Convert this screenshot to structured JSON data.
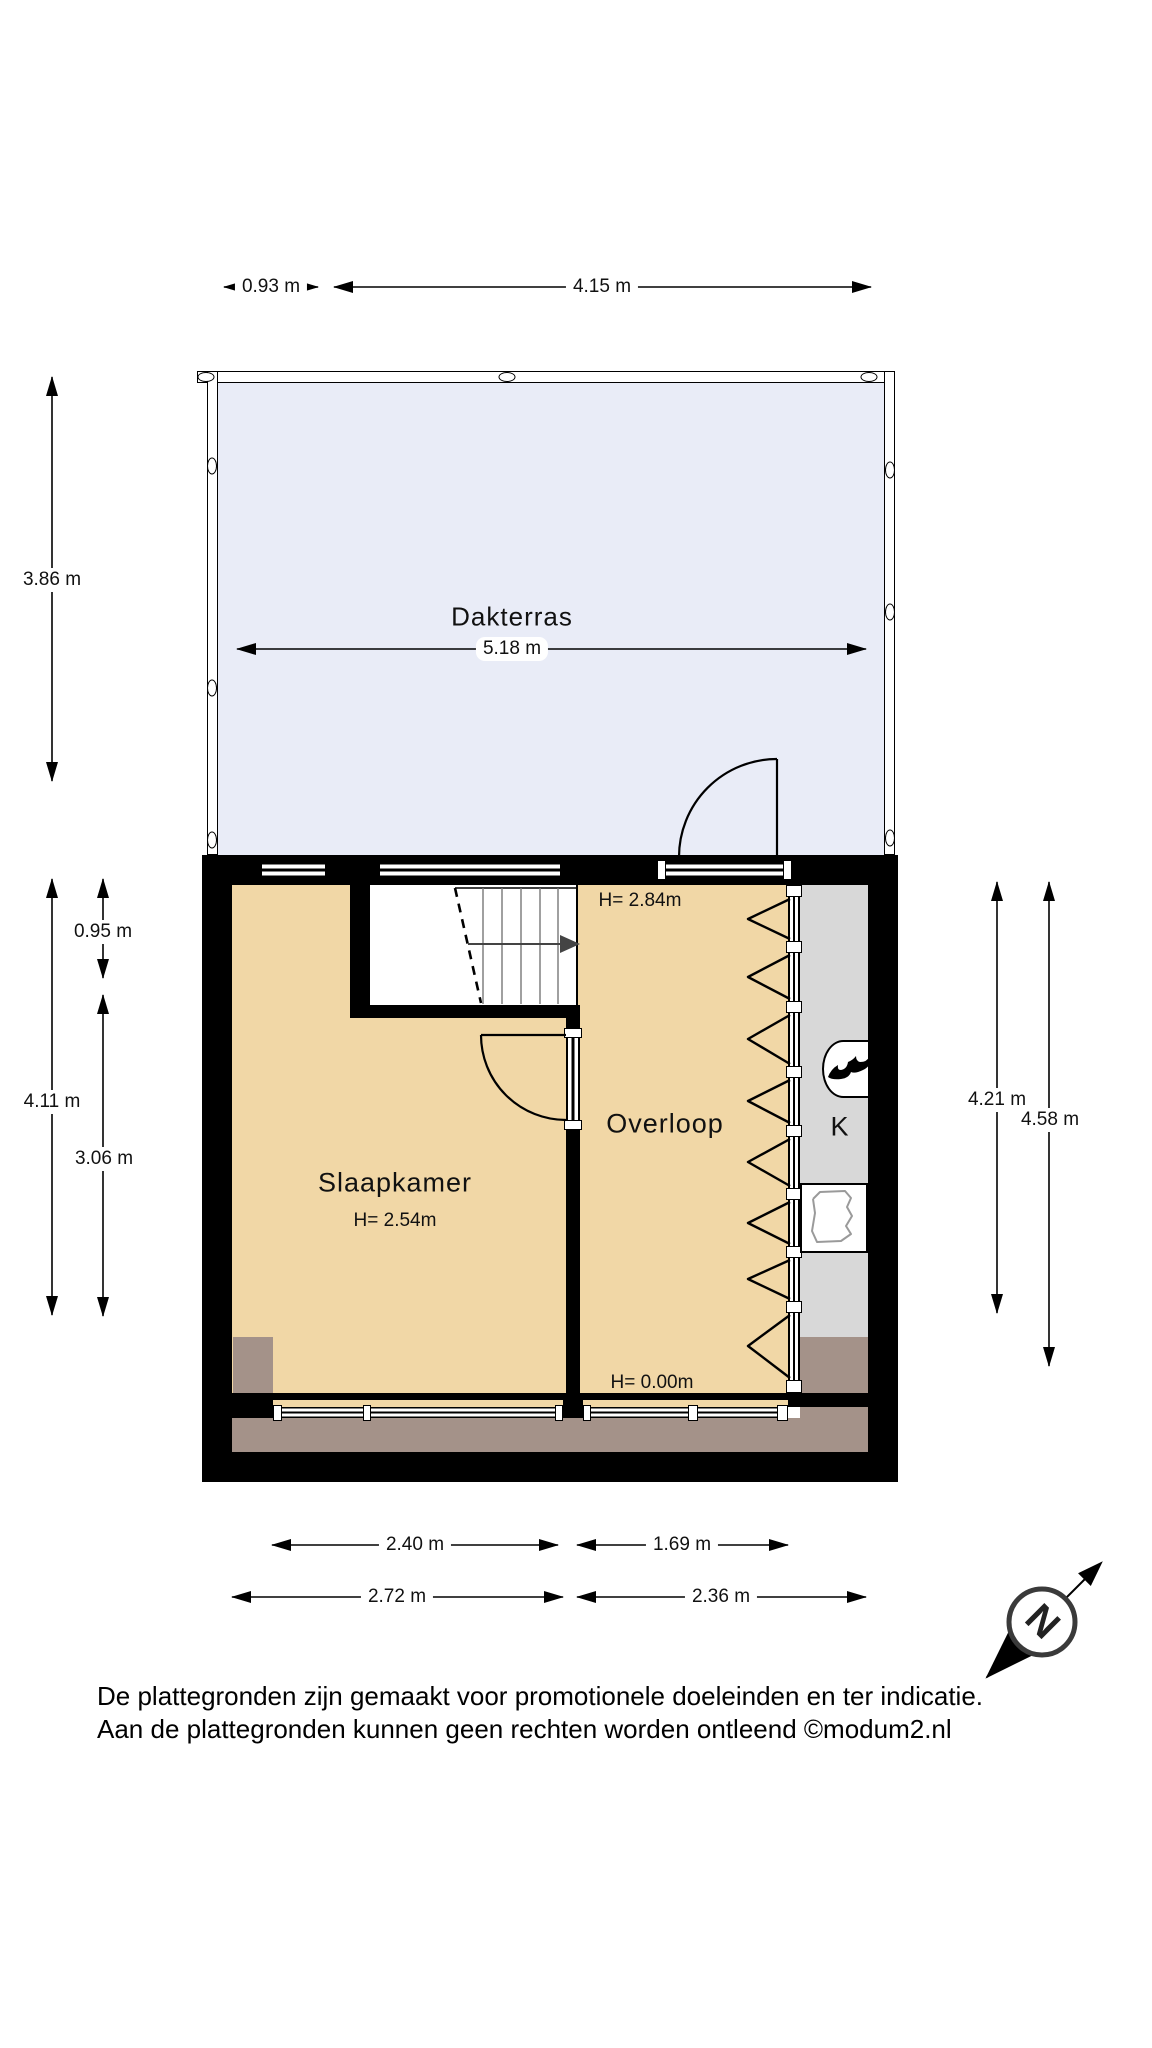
{
  "terrace": {
    "label": "Dakterras",
    "width_dim": "5.18 m"
  },
  "rooms": {
    "bedroom": {
      "name": "Slaapkamer",
      "ceiling": "H= 2.54m"
    },
    "landing": {
      "name": "Overloop",
      "ceiling": "H= 2.84m",
      "edge_height": "H= 0.00m"
    },
    "closet": {
      "name": "K"
    }
  },
  "dimensions": {
    "top_left": "0.93 m",
    "top_right": "4.15 m",
    "left_terrace": "3.86 m",
    "left_upper": "0.95 m",
    "left_full": "4.11 m",
    "left_lower": "3.06 m",
    "right_inner": "4.21 m",
    "right_outer": "4.58 m",
    "bottom_inner_left": "2.40 m",
    "bottom_inner_right": "1.69 m",
    "bottom_outer_left": "2.72 m",
    "bottom_outer_right": "2.36 m"
  },
  "compass": {
    "north_label": "N"
  },
  "footer": {
    "line1": "De plattegronden zijn gemaakt voor promotionele doeleinden en ter indicatie.",
    "line2": "Aan de plattegronden kunnen geen rechten worden ontleend ©modum2.nl"
  },
  "colors": {
    "floor_tan": "#f1d7a6",
    "terrace_blue": "#e9ecf7",
    "closet_gray": "#d8d8d8",
    "roof_brown": "#a49289",
    "wall_black": "#000000"
  }
}
